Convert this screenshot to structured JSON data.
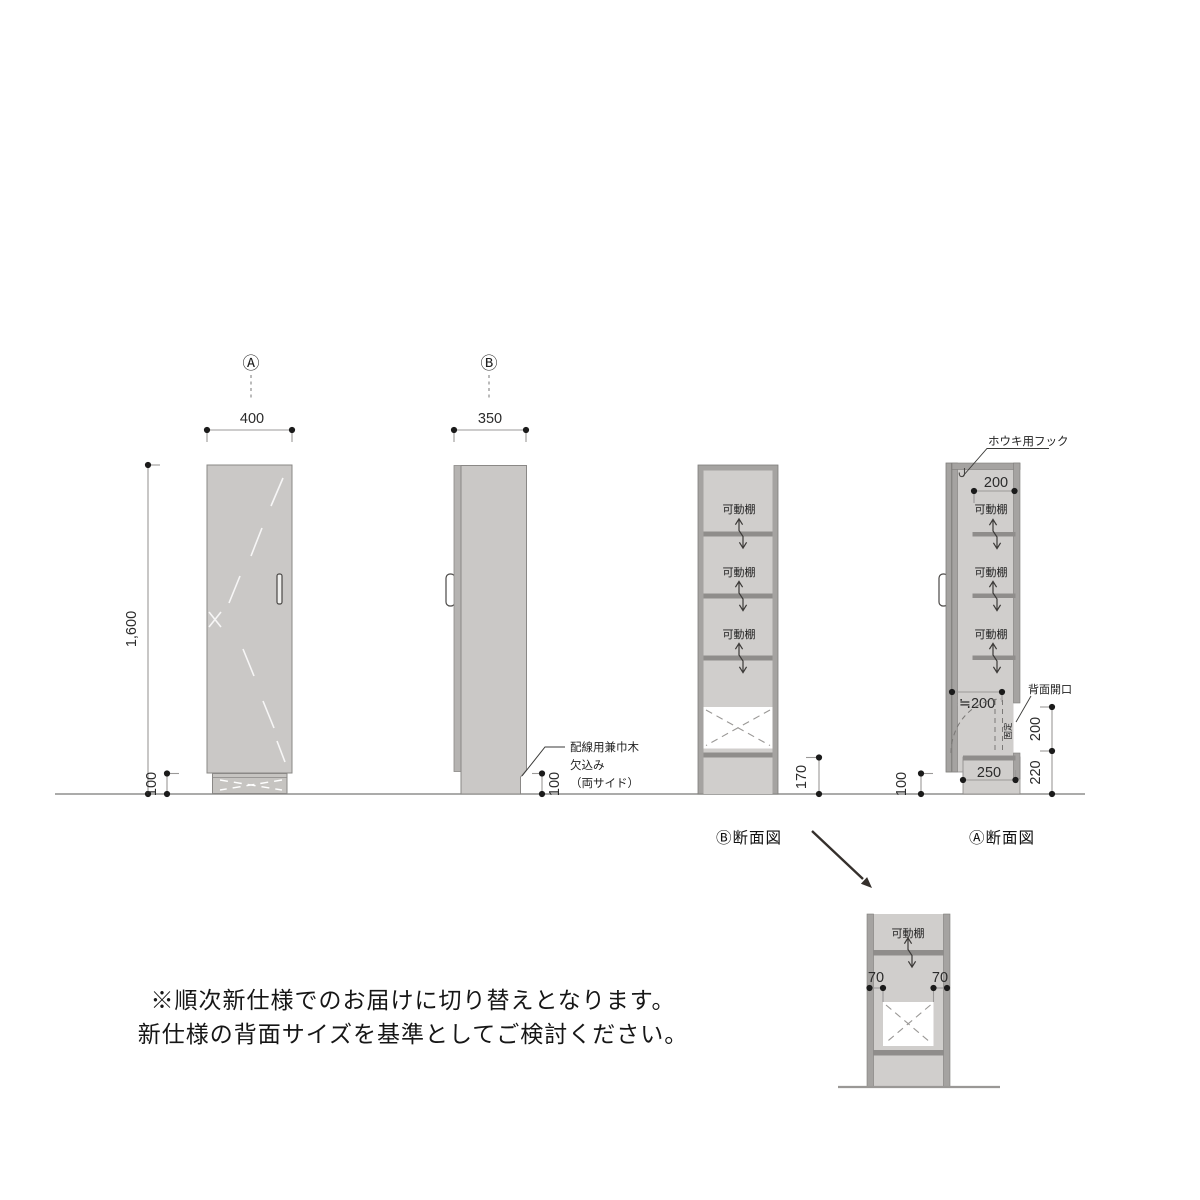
{
  "drawing": {
    "front_view": {
      "marker": "Ⓐ",
      "width": "400",
      "height": "1,600",
      "base_height": "100"
    },
    "side_view": {
      "marker": "Ⓑ",
      "depth": "350",
      "note_line1": "配線用兼巾木",
      "note_line2": "欠込み",
      "note_line3": "（両サイド）",
      "notch_height": "100"
    },
    "section_b": {
      "caption": "Ⓑ断面図",
      "shelf_label": "可動棚",
      "bottom_clearance": "170"
    },
    "section_a": {
      "caption": "Ⓐ断面図",
      "hook_note": "ホウキ用フック",
      "shelf_depth": "200",
      "shelf_label": "可動棚",
      "door_clearance": "≒200",
      "back_opening_note": "背面開口",
      "fixed_label": "固定",
      "base_depth": "250",
      "notch_height": "100",
      "opening_height": "200",
      "base_total_height": "220"
    },
    "detail_view": {
      "shelf_label": "可動棚",
      "left_offset": "70",
      "right_offset": "70"
    },
    "footnote": {
      "line1": "※順次新仕様でのお届けに切り替えとなります。",
      "line2": "新仕様の背面サイズを基準としてご検討ください。"
    }
  },
  "colors": {
    "panel_fill": "#cac8c6",
    "section_interior_fill": "#d0cecc",
    "wall_fill": "#a5a3a1",
    "shelf_fill": "#8f8d8b",
    "outline": "#8a8886",
    "dim_line": "#9b9998",
    "dot": "#1b1b1b",
    "annotation_arrow": "#35302c"
  }
}
